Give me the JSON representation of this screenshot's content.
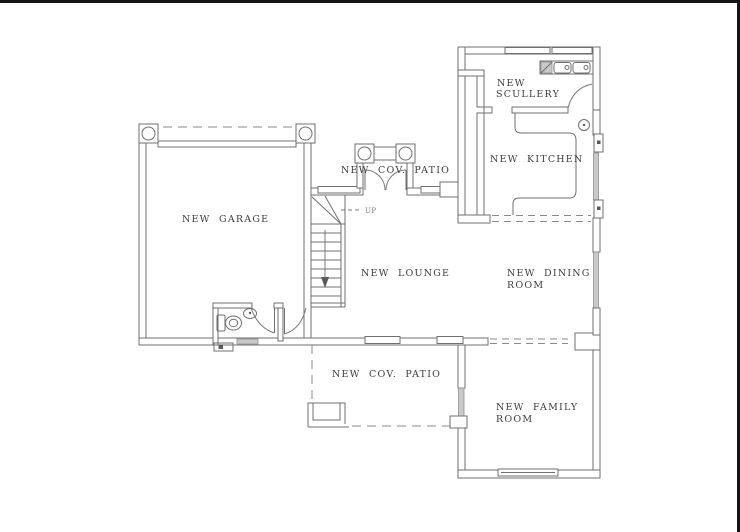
{
  "drawing": {
    "type": "architectural-floor-plan",
    "rooms": {
      "garage": "NEW  GARAGE",
      "patio_top": "NEW  COV.  PATIO",
      "scullery_line1": "NEW",
      "scullery_line2": "SCULLERY",
      "kitchen": "NEW  KITCHEN",
      "lounge": "NEW  LOUNGE",
      "dining_line1": "NEW  DINING",
      "dining_line2": "ROOM",
      "patio_bottom": "NEW  COV.  PATIO",
      "family_line1": "NEW  FAMILY",
      "family_line2": "ROOM",
      "stairs_up": "UP"
    },
    "colors": {
      "wall_line": "#6f6f6f",
      "text": "#3c3c3c",
      "window_glazing": "#c9c9c9",
      "frame_border": "#141414",
      "background": "#ffffff"
    }
  }
}
